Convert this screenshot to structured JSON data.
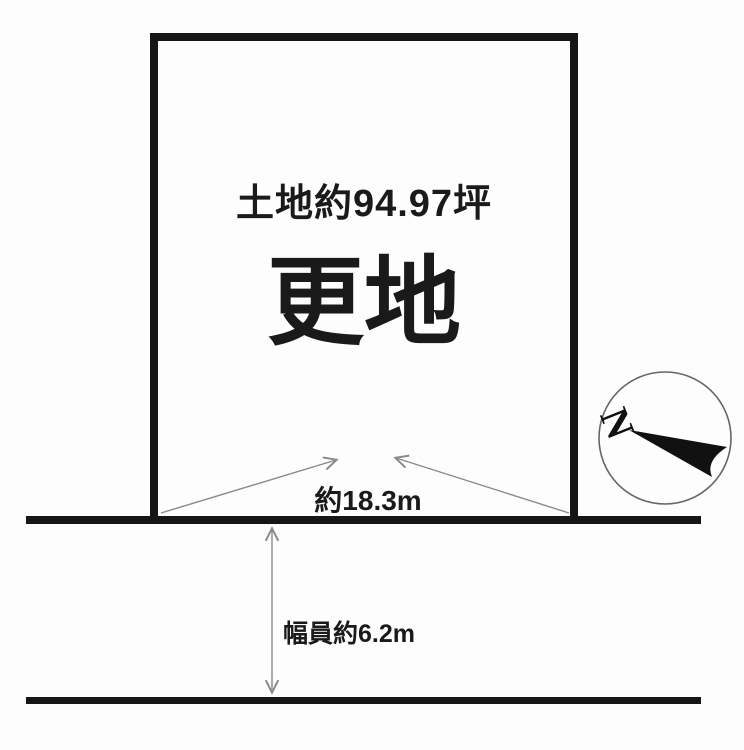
{
  "diagram": {
    "title_note": "land plot layout drawing",
    "land_area_label": "土地約94.97坪",
    "land_status_label": "更地",
    "frontage_label": "約18.3m",
    "road_width_label": "幅員約6.2m",
    "compass": {
      "north_label": "N"
    },
    "colors": {
      "background": "#fdfdfd",
      "outline": "#161616",
      "arrow": "#8a8a8a",
      "text": "#1a1a1a",
      "compass_ring": "#666666",
      "needle": "#111111"
    }
  }
}
